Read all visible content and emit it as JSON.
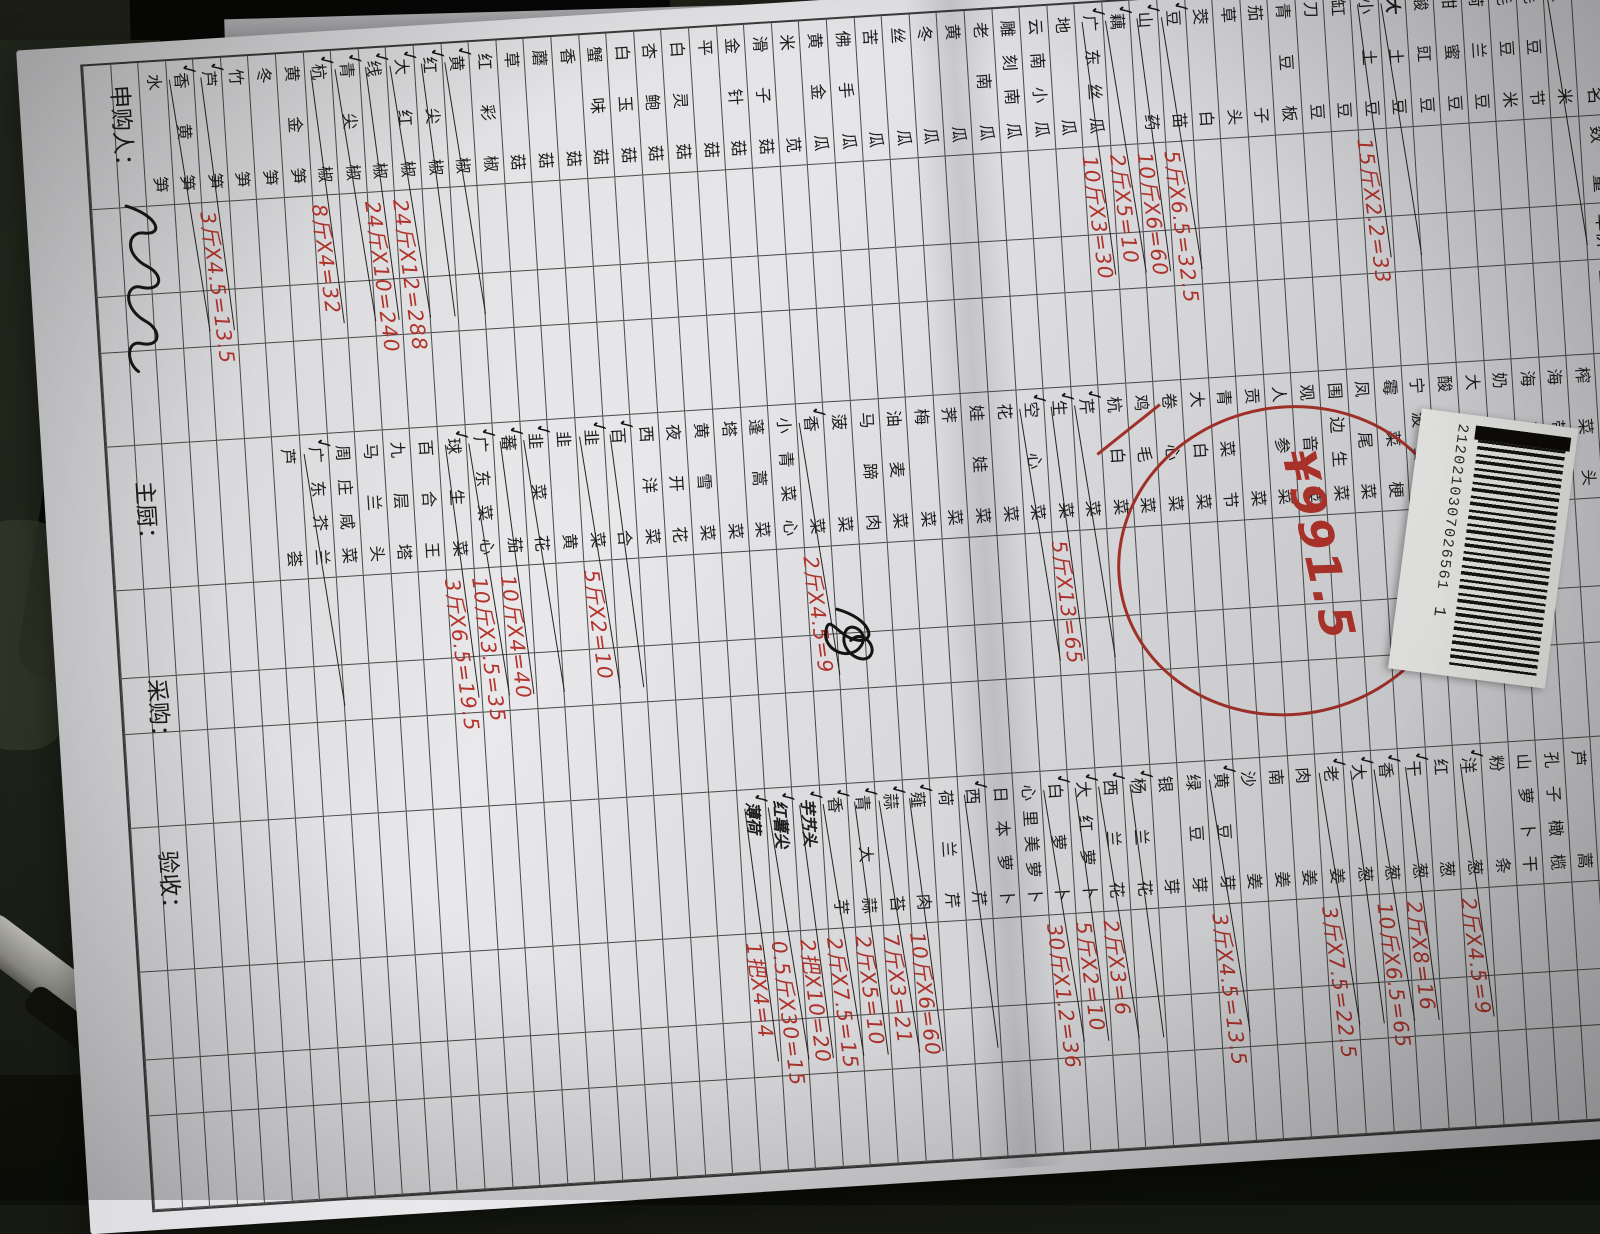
{
  "scene": {
    "desk_color": "#171a12",
    "paper_color": "#e4e4e8",
    "ink_red": "#b5342c",
    "ink_black": "#1c1c1c"
  },
  "form": {
    "date": "2021年3月7日",
    "total_mark": "总",
    "title": "皇家蔬菜汇总单",
    "margin_note_black": "5斤",
    "margin_note_red": "X3.5=17.5",
    "header": [
      "品名",
      "数量",
      "单价",
      "金额"
    ],
    "circle_total": "¥991.5",
    "barcode_number": "2120210307026561",
    "barcode_suffix": "1",
    "footer": [
      {
        "label": "申购人："
      },
      {
        "label": "主厨："
      },
      {
        "label": "采购："
      },
      {
        "label": "验收："
      }
    ],
    "groups": [
      {
        "items": [
          {
            "n": "玉米",
            "k": true
          },
          {
            "n": "毛豆节"
          },
          {
            "n": "毛豆米"
          },
          {
            "n": "荷兰豆"
          },
          {
            "n": "甜蜜豆"
          },
          {
            "n": "酸豇豆"
          },
          {
            "n": "土豆",
            "p": "大",
            "k": true
          },
          {
            "n": "小土豆",
            "k": true,
            "c": "15斤X2.2=33"
          },
          {
            "n": "缸豆"
          },
          {
            "n": "刀豆"
          },
          {
            "n": "青豆板"
          },
          {
            "n": "茄子"
          },
          {
            "n": "草头"
          },
          {
            "n": "茭白"
          },
          {
            "n": "豆苗",
            "k": true,
            "c": "5斤X6.5=32.5"
          },
          {
            "n": "山药",
            "k": true,
            "c": "10斤X6=60"
          },
          {
            "n": "藕",
            "k": true,
            "c": "2斤X5=10"
          },
          {
            "n": "广东丝瓜",
            "k": true,
            "c": "10斤X3=30"
          },
          {
            "n": "地瓜"
          },
          {
            "n": "云南小瓜"
          },
          {
            "n": "雕刻南瓜"
          },
          {
            "n": "老南瓜"
          },
          {
            "n": "黄瓜"
          },
          {
            "n": "冬瓜"
          },
          {
            "n": "丝瓜"
          },
          {
            "n": "苦瓜"
          },
          {
            "n": "佛手瓜"
          },
          {
            "n": "黄金瓜"
          },
          {
            "n": "米苋"
          },
          {
            "n": "滑子菇"
          },
          {
            "n": "金针菇"
          },
          {
            "n": "平菇"
          },
          {
            "n": "白灵菇"
          },
          {
            "n": "杏鲍菇"
          },
          {
            "n": "白玉菇"
          },
          {
            "n": "蟹味菇"
          },
          {
            "n": "香菇"
          },
          {
            "n": "蘑菇"
          },
          {
            "n": "草菇"
          },
          {
            "n": "红彩椒"
          },
          {
            "n": "黄椒",
            "k": true
          },
          {
            "n": "红尖椒",
            "k": true
          },
          {
            "n": "大红椒",
            "k": true,
            "c": "24斤X12=288"
          },
          {
            "n": "线椒",
            "k": true,
            "c": "24斤X10=240"
          },
          {
            "n": "青尖椒",
            "k": true
          },
          {
            "n": "杭椒",
            "k": true,
            "c": "8斤X4=32"
          },
          {
            "n": "黄金笋"
          },
          {
            "n": "冬笋"
          },
          {
            "n": "竹笋"
          },
          {
            "n": "芦笋",
            "k": true,
            "c": "3斤X4.5=13.5"
          },
          {
            "n": "香黄笋",
            "k": true
          },
          {
            "n": "水笋"
          }
        ]
      },
      {
        "items": [
          {
            "n": "榨菜头"
          },
          {
            "n": "海带结"
          },
          {
            "n": "海带丝"
          },
          {
            "n": "奶白菜"
          },
          {
            "n": "大头菜"
          },
          {
            "n": "酸菜"
          },
          {
            "n": "宁波雪菜"
          },
          {
            "n": "霉菜梗"
          },
          {
            "n": "凤尾菜"
          },
          {
            "n": "围边生菜"
          },
          {
            "n": "观音菜"
          },
          {
            "n": "人参菜"
          },
          {
            "n": "贡菜"
          },
          {
            "n": "青菜节"
          },
          {
            "n": "大白菜"
          },
          {
            "n": "卷心菜"
          },
          {
            "n": "鸡毛菜"
          },
          {
            "n": "杭白菜"
          },
          {
            "n": "芹菜",
            "k": true
          },
          {
            "n": "生菜",
            "k": true,
            "c": "5斤X13=65"
          },
          {
            "n": "空心菜",
            "k": true
          },
          {
            "n": "花菜"
          },
          {
            "n": "娃娃菜"
          },
          {
            "n": "荠菜"
          },
          {
            "n": "梅菜"
          },
          {
            "n": "油麦菜"
          },
          {
            "n": "马蹄肉"
          },
          {
            "n": "菠菜",
            "b": true
          },
          {
            "n": "香菜",
            "k": true,
            "c": "2斤X4.5=9"
          },
          {
            "n": "小青菜心"
          },
          {
            "n": "蓬蒿菜"
          },
          {
            "n": "塔菜"
          },
          {
            "n": "黄雪菜"
          },
          {
            "n": "夜开花"
          },
          {
            "n": "西洋菜"
          },
          {
            "n": "百合",
            "k": true
          },
          {
            "n": "韭菜",
            "k": true,
            "c": "5斤X2=10"
          },
          {
            "n": "韭黄"
          },
          {
            "n": "韭菜花",
            "k": true
          },
          {
            "n": "蕃茄",
            "k": true,
            "c": "10斤X4=40"
          },
          {
            "n": "广东菜心",
            "k": true,
            "c": "10斤X3.5=35"
          },
          {
            "n": "球生菜",
            "k": true,
            "c": "3斤X6.5=19.5"
          },
          {
            "n": "百合王"
          },
          {
            "n": "九层塔"
          },
          {
            "n": "马兰头"
          },
          {
            "n": "周庄咸菜"
          },
          {
            "n": "广东芥兰",
            "k": true
          },
          {
            "n": "芦荟"
          }
        ]
      },
      {
        "items": [
          {
            "n": "红牛肝菌"
          },
          {
            "n": "芦蒿"
          },
          {
            "n": "孔子橄榄"
          },
          {
            "n": "山萝卜干"
          },
          {
            "n": "粉条"
          },
          {
            "n": "洋葱",
            "k": true,
            "c": "2斤X4.5=9"
          },
          {
            "n": "红葱"
          },
          {
            "n": "干葱",
            "k": true,
            "c": "2斤X8=16"
          },
          {
            "n": "香葱",
            "k": true,
            "c": "10斤X6.5=65"
          },
          {
            "n": "大葱",
            "k": true
          },
          {
            "n": "老姜",
            "k": true,
            "c": "3斤X7.5=22.5"
          },
          {
            "n": "肉姜"
          },
          {
            "n": "南姜"
          },
          {
            "n": "沙姜"
          },
          {
            "n": "黄豆芽",
            "k": true,
            "c": "3斤X4.5=13.5"
          },
          {
            "n": "绿豆芽"
          },
          {
            "n": "银芽"
          },
          {
            "n": "杨兰花",
            "k": true
          },
          {
            "n": "西兰花",
            "k": true,
            "c": "2斤X3=6"
          },
          {
            "n": "大红萝卜",
            "k": true,
            "c": "5斤X2=10"
          },
          {
            "n": "白萝卜",
            "k": true,
            "c": "30斤X1.2=36"
          },
          {
            "n": "心里美萝卜"
          },
          {
            "n": "日本萝卜"
          },
          {
            "n": "西芹",
            "k": true
          },
          {
            "n": "荷兰芹"
          },
          {
            "n": "薤肉",
            "k": true,
            "c": "10斤X6=60"
          },
          {
            "n": "蒜苔",
            "k": true,
            "c": "7斤X3=21"
          },
          {
            "n": "青大蒜",
            "k": true,
            "c": "2斤X5=10"
          },
          {
            "n": "香芋",
            "k": true,
            "c": "2斤X7.5=15"
          },
          {
            "n": "芋艿头",
            "h": true,
            "k": true,
            "c": "2把X10=20"
          },
          {
            "n": "红薯尖",
            "h": true,
            "k": true,
            "c": "0.5斤X30=15"
          },
          {
            "n": "薄荷",
            "h": true,
            "k": true,
            "c": "1把X4=4"
          }
        ]
      }
    ]
  }
}
